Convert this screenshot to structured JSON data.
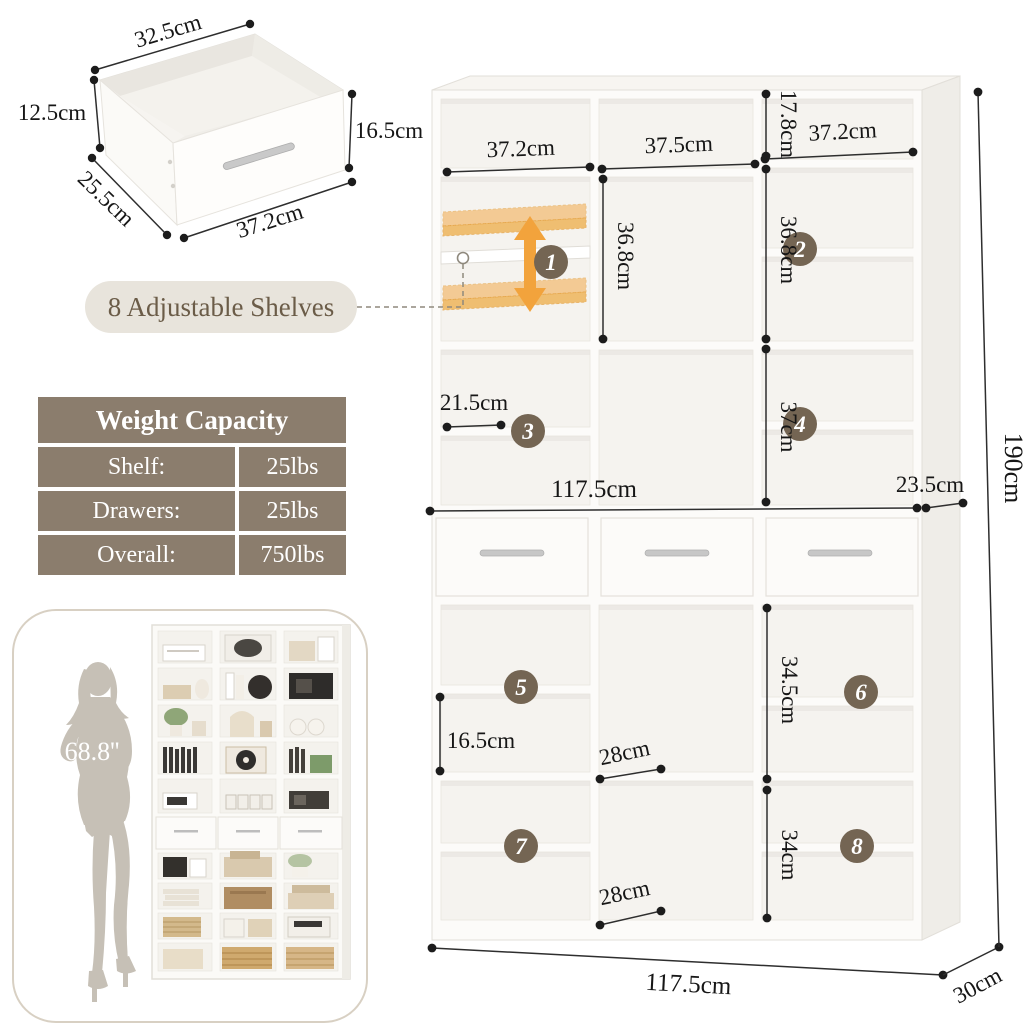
{
  "drawer_detail": {
    "top_width": "32.5cm",
    "side_height": "12.5cm",
    "depth": "25.5cm",
    "front_width": "37.2cm",
    "front_height": "16.5cm"
  },
  "callout": {
    "label": "8 Adjustable Shelves"
  },
  "weight_table": {
    "title": "Weight Capacity",
    "rows": [
      {
        "label": "Shelf:",
        "value": "25lbs"
      },
      {
        "label": "Drawers:",
        "value": "25lbs"
      },
      {
        "label": "Overall:",
        "value": "750lbs"
      }
    ]
  },
  "figure": {
    "height_label": "68.8''"
  },
  "diagram": {
    "col_widths": {
      "left": "37.2cm",
      "middle": "37.5cm",
      "right": "37.2cm"
    },
    "cell_heights": {
      "top_right": "17.8cm",
      "middle": "36.8cm",
      "upper_right": "36.8cm",
      "right_fourth": "37cm",
      "lower_left": "16.5cm",
      "lower_right_upper": "34.5cm",
      "lower_right_lower": "34cm"
    },
    "depths": {
      "shelf_left": "21.5cm",
      "hutch": "23.5cm",
      "lower_mid_upper": "28cm",
      "lower_mid_lower": "28cm",
      "base": "30cm"
    },
    "widths": {
      "hutch": "117.5cm",
      "base": "117.5cm"
    },
    "total_height": "190cm",
    "badges": [
      "1",
      "2",
      "3",
      "4",
      "5",
      "6",
      "7",
      "8"
    ]
  },
  "colors": {
    "accent_orange": "#F2A33C",
    "badge_brown": "#746553",
    "table_taupe": "#8B7D6D",
    "pill_bg": "#E8E4DC",
    "silhouette_gray": "#C6C0B6"
  }
}
